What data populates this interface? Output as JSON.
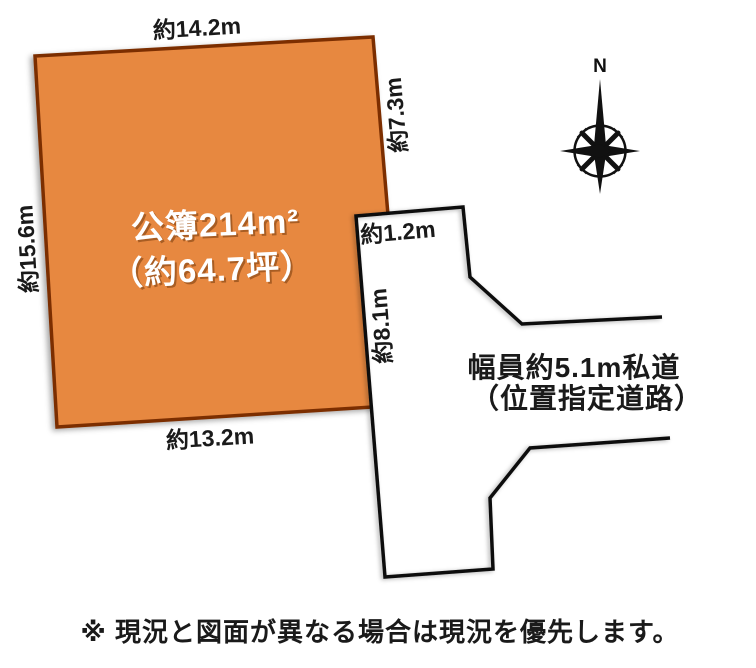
{
  "diagram": {
    "colors": {
      "background": "#ffffff",
      "parcel_fill": "#e78840",
      "parcel_border": "#7b2f04",
      "road_fill": "#ffffff",
      "road_line": "#111111",
      "label_text": "#1a1a1a",
      "area_text": "#ffffff",
      "area_text_shadow": "rgba(105,50,5,0.5)",
      "compass": "#111111"
    },
    "parcel": {
      "area_line1": "公簿214m²",
      "area_line2": "（約64.7坪）",
      "dim_top": "約14.2m",
      "dim_left": "約15.6m",
      "dim_bottom": "約13.2m",
      "dim_right": "約7.3m"
    },
    "road": {
      "dim_width_top": "約1.2m",
      "dim_frontage": "約8.1m",
      "name_line1": "幅員約5.1m私道",
      "name_line2": "（位置指定道路）"
    },
    "compass": {
      "north_label": "N"
    },
    "note": "※ 現況と図面が異なる場合は現況を優先します。"
  }
}
